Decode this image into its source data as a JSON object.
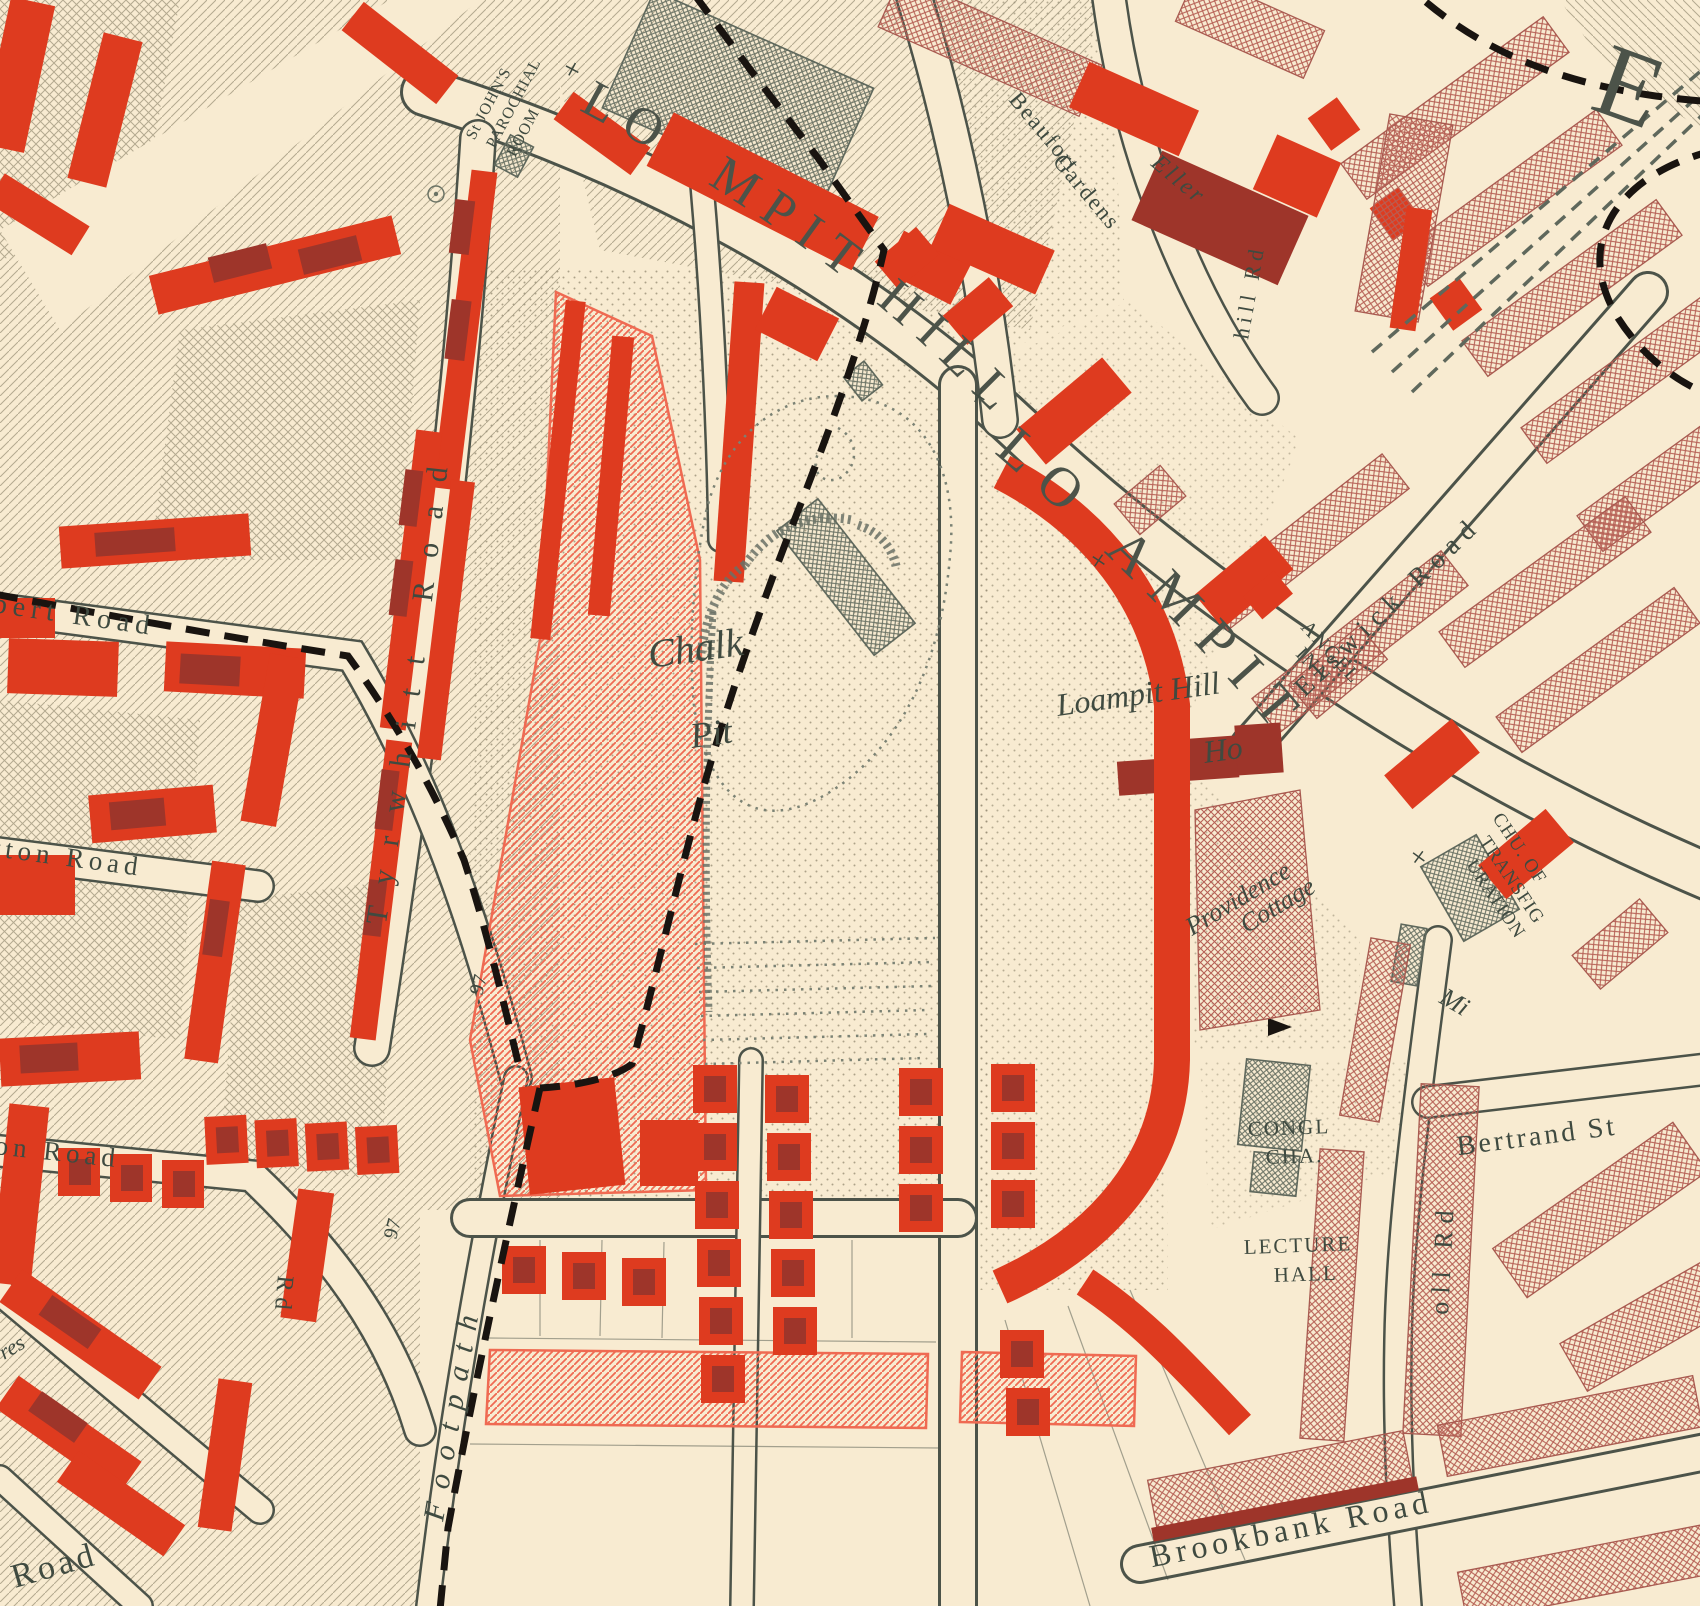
{
  "glyphs": {
    "cross": "+"
  },
  "colors": {
    "cream": "#f8ebd1",
    "ink": "#4c5349",
    "text": "#3f4a40",
    "red": "#de3b1f",
    "darkred": "#9e352a",
    "pink": "#ef6a52",
    "brown": "#a85a50",
    "gray": "#5f685c",
    "black": "#191410"
  },
  "streets": {
    "loampit_hill_upper": [
      "LO",
      "MPIT HILL"
    ],
    "loampit_hill_lower": [
      "LO",
      "AMPIT"
    ],
    "elswick_road": "Elswick Road",
    "tyrwhitt_road": "Tyrwhitt Road",
    "bert_road_fragment": "bert Road",
    "tton_road_fragment": "tton Road",
    "on_road_fragment": "on Road",
    "road_fragment": "Road",
    "res_fragment": "res",
    "rd_fragment": "Rd",
    "oll_rd_fragment": "oll Rd",
    "hill_rd_fragment": "hill Rd",
    "eller_fragment": "Eller",
    "beaufort": "Beaufort",
    "gardens": "Gardens",
    "bertrand_street": "Bertrand St",
    "brookbank_road": "Brookbank Road",
    "footpath": "Footpath"
  },
  "places": {
    "st_johns": [
      "St JOHN'S",
      "PAROCHIAL",
      "ROOM"
    ],
    "chalk_pit": [
      "Chalk",
      "Pit"
    ],
    "loampit_hill_house": [
      "Loampit Hill",
      "Ho"
    ],
    "angel_inn": [
      "ANGEL",
      "INN"
    ],
    "providence": [
      "Providence",
      "Cottage"
    ],
    "transfiguration": [
      "CHU. OF",
      "TRANSFIG",
      "URATION"
    ],
    "mission_fragment": "Mi",
    "congregational_chapel": [
      "CONGL",
      "CHA."
    ],
    "lecture_hall": [
      "LECTURE",
      "HALL"
    ],
    "plot_numbers": [
      "97",
      "97"
    ],
    "district_letter_fragment": "E"
  }
}
